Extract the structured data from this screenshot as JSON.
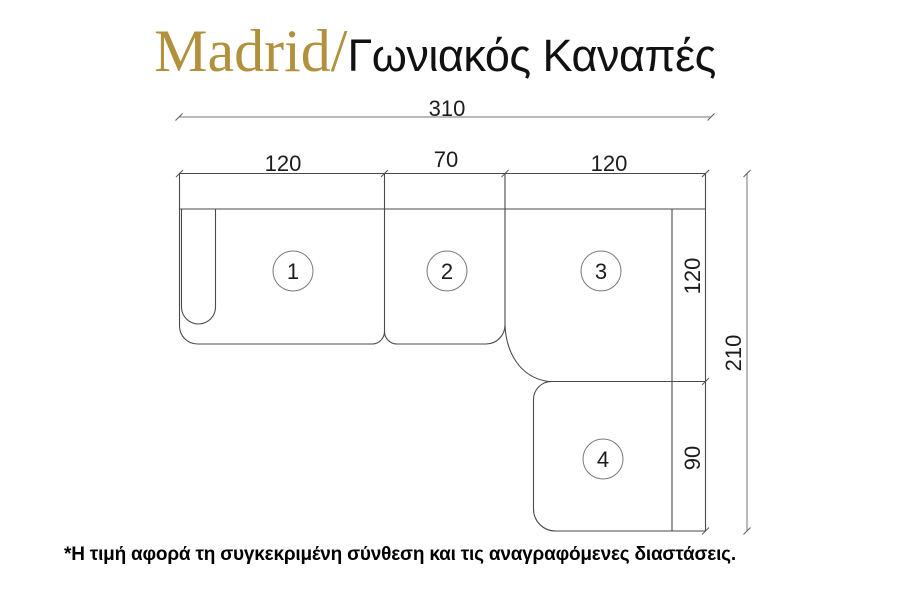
{
  "header": {
    "brand": "Madrid/",
    "subtitle": "Γωνιακός Καναπές",
    "brand_color": "#b2913e"
  },
  "diagram": {
    "type": "sofa-floor-plan",
    "dim_total_width": "310",
    "dim_seg_left": "120",
    "dim_seg_mid": "70",
    "dim_seg_right": "120",
    "dim_right_upper": "120",
    "dim_right_lower": "90",
    "dim_total_depth": "210",
    "modules": [
      {
        "number": "1"
      },
      {
        "number": "2"
      },
      {
        "number": "3"
      },
      {
        "number": "4"
      }
    ],
    "dimensions_cm": {
      "total_width": 310,
      "top_segments": [
        120,
        70,
        120
      ],
      "right_segments": [
        120,
        90
      ],
      "total_depth": 210
    },
    "outline_color": "#4a4a4a",
    "dimension_color": "#757575"
  },
  "footer": {
    "note": "*Η τιμή αφορά τη συγκεκριμένη σύνθεση και τις αναγραφόμενες διαστάσεις."
  }
}
